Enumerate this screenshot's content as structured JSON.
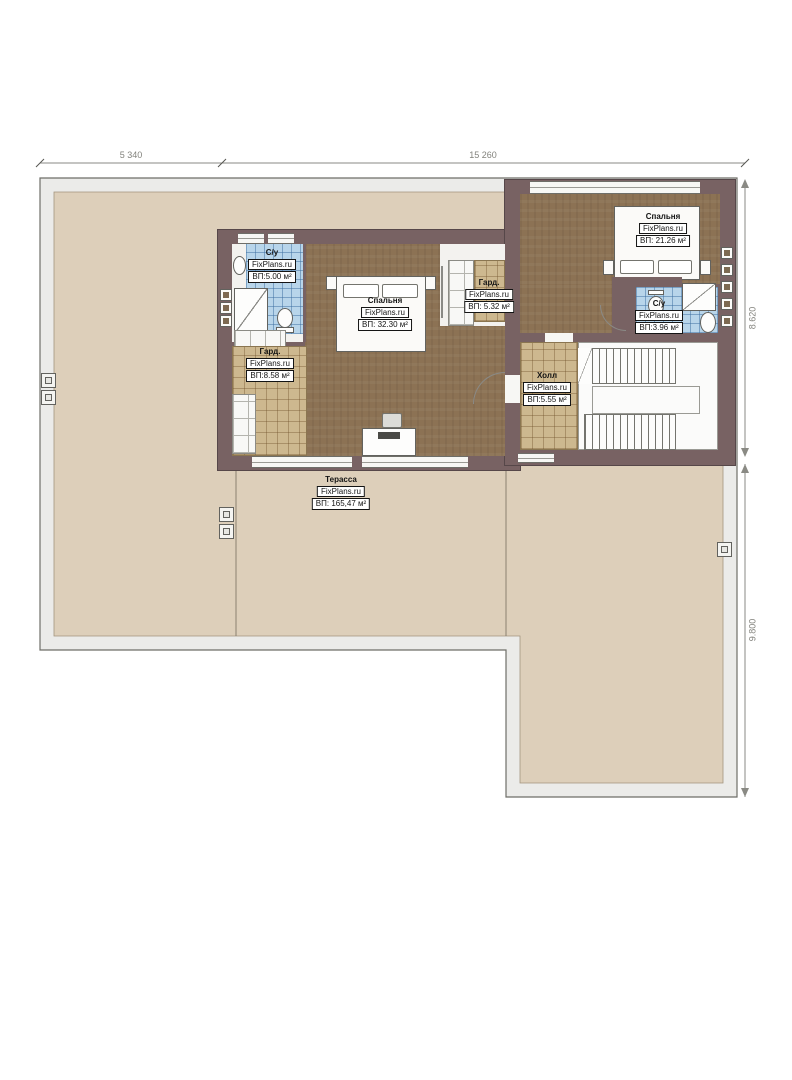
{
  "watermark": "FixPlans.ru",
  "dimensions": {
    "width_left": "5 340",
    "width_right": "15 260",
    "height_upper": "8.620",
    "height_lower": "9.800"
  },
  "rooms": {
    "bath_left": {
      "name": "С/у",
      "area": "ВП:5.00 м²"
    },
    "bedroom_main": {
      "name": "Спальня",
      "area": "ВП: 32.30 м²"
    },
    "wardrobe_small": {
      "name": "Гард.",
      "area": "ВП: 5.32 м²"
    },
    "bedroom_right": {
      "name": "Спальня",
      "area": "ВП: 21.26 м²"
    },
    "bath_right": {
      "name": "С/у",
      "area": "ВП:3.96 м²"
    },
    "wardrobe_large": {
      "name": "Гард.",
      "area": "ВП:8.58 м²"
    },
    "hall": {
      "name": "Холл",
      "area": "ВП:5.55 м²"
    },
    "terrace": {
      "name": "Терасса",
      "area": "ВП: 165,47 м²"
    }
  },
  "colors": {
    "wall": "#786263",
    "wood_floor": "#8c7254",
    "tile_tan": "#cdb88f",
    "tile_blue": "#b8d5ea",
    "deck_band": "#ebebe9",
    "terrace_floor": "#ddcfba"
  }
}
